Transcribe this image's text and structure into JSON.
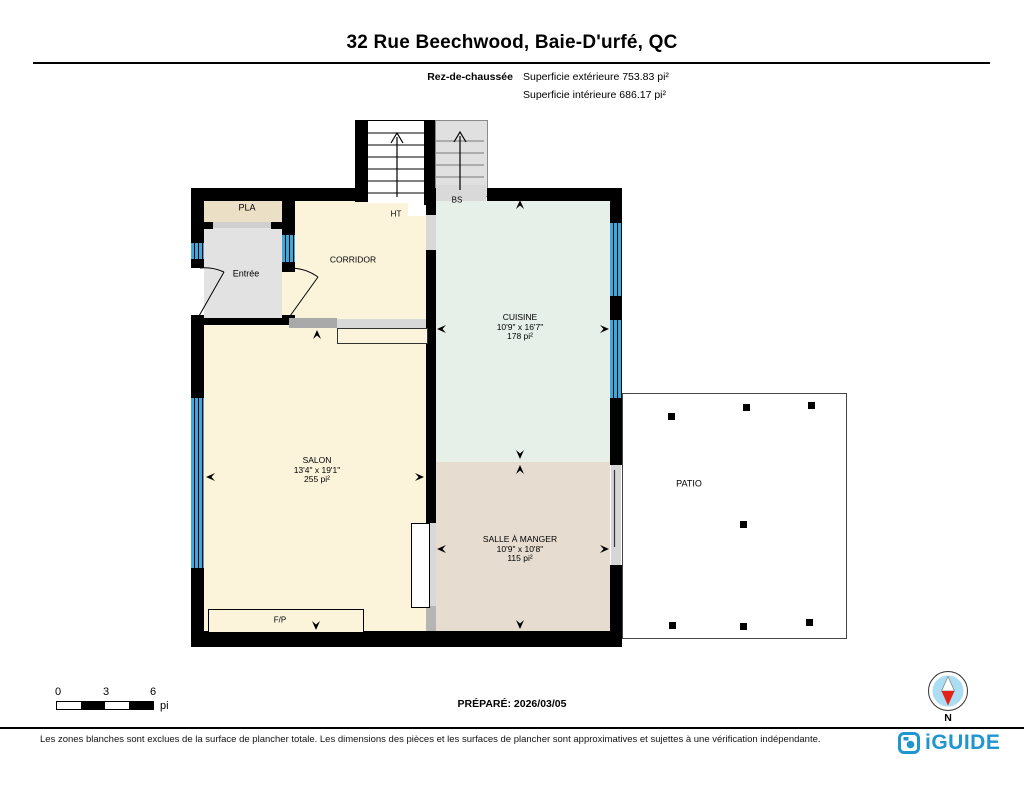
{
  "header": {
    "title": "32 Rue Beechwood, Baie-D'urfé, QC",
    "floor_label": "Rez-de-chaussée",
    "area_exterior": "Superficie extérieure 753.83 pi²",
    "area_interior": "Superficie intérieure 686.17 pi²"
  },
  "rooms": {
    "pla": {
      "label": "PLA"
    },
    "entree": {
      "label": "Entrée"
    },
    "corridor": {
      "label": "CORRIDOR"
    },
    "ht": {
      "label": "HT"
    },
    "bs": {
      "label": "BS"
    },
    "cuisine": {
      "label": "CUISINE",
      "dimensions": "10'9\" x 16'7\"",
      "area": "178 pi²"
    },
    "salon": {
      "label": "SALON",
      "dimensions": "13'4\" x 19'1\"",
      "area": "255 pi²"
    },
    "salle_a_manger": {
      "label": "SALLE À MANGER",
      "dimensions": "10'9\" x 10'8\"",
      "area": "115 pi²"
    },
    "patio": {
      "label": "PATIO"
    },
    "fireplace": {
      "label": "F/P"
    }
  },
  "scale_bar": {
    "t0": "0",
    "t3": "3",
    "t6": "6",
    "unit": "pi"
  },
  "prepared": "PRÉPARÉ: 2026/03/05",
  "compass": {
    "n": "N"
  },
  "footer": {
    "disclaimer": "Les zones blanches sont exclues de la surface de plancher totale. Les dimensions des pièces et les surfaces de plancher sont approximatives et sujettes à une vérification indépendante.",
    "brand": "iGUIDE"
  },
  "colors": {
    "window_blue": "#42a6da",
    "brand_blue": "#2095ce",
    "compass_red": "#e32119",
    "cream": "#fbf4db",
    "mint": "#e6f0e9",
    "tan": "#e6ddd0"
  }
}
